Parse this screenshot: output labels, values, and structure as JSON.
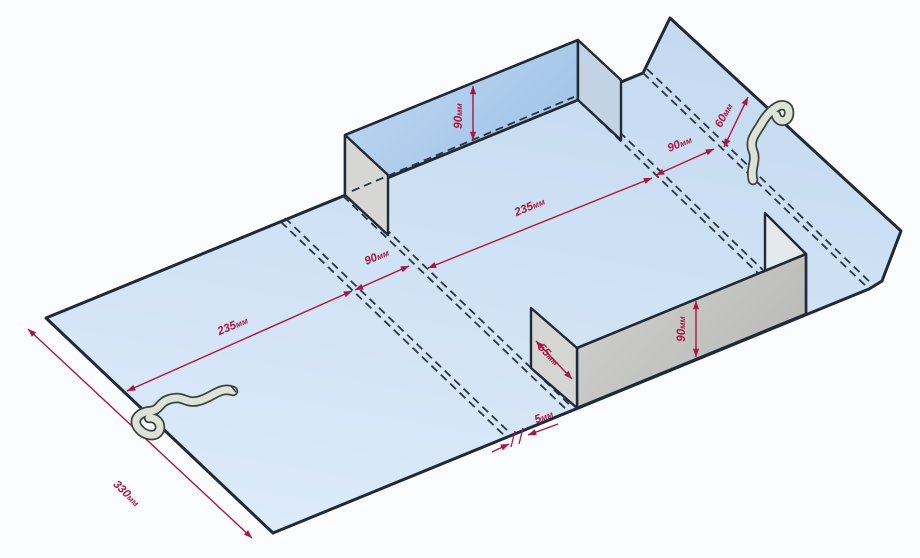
{
  "meta": {
    "description": "Isometric die-line drawing of a cardboard box blank with erected walls, fold lines, fabric straps and dimension annotations",
    "canvas": {
      "width": 920,
      "height": 558,
      "background": "#fbfcfd"
    }
  },
  "colors": {
    "outline": "#202a36",
    "fold": "#2a3542",
    "dimension": "#a81843",
    "strap_outline": "#3a433d",
    "strap_fill": "#dde2d6",
    "background": "#fbfcfd"
  },
  "dimension_labels": [
    "90мм",
    "60мм",
    "90мм",
    "235мм",
    "90мм",
    "235мм",
    "330мм",
    "55мм",
    "90мм",
    "5мм"
  ],
  "diagram": {
    "polygons": [
      {
        "name": "flat-sheet",
        "points": "46,318 643,73 670,18 901,231 882,281 869,289 273,533",
        "fill": {
          "type": "linear",
          "from": "#c5daf0",
          "to": "#dceafa",
          "x1": 0.6,
          "y1": 0,
          "x2": 0.3,
          "y2": 1
        },
        "stroke_width": 3
      },
      {
        "name": "front-wall-right-flap",
        "points": "765,213 806,254 806,314 765,273",
        "fill": "#e4e9ee",
        "stroke_width": 2.4
      },
      {
        "name": "front-wall",
        "points": "577,348 806,254 806,314 577,408",
        "fill": {
          "type": "linear",
          "from": "#cfd0ce",
          "to": "#b7b8b5",
          "x1": 0,
          "y1": 0.2,
          "x2": 1,
          "y2": 0.8
        },
        "stroke_width": 2.6
      },
      {
        "name": "front-wall-left-flap-55mm",
        "points": "531,308 577,348 577,408 531,368",
        "fill": "#d5d6d4",
        "stroke_width": 2.4
      },
      {
        "name": "back-wall",
        "points": "345,135 578,40 578,100 345,195",
        "fill": {
          "type": "linear",
          "from": "#c2d9f2",
          "to": "#9ec2e7",
          "x1": 0,
          "y1": 0,
          "x2": 1,
          "y2": 0.7
        },
        "stroke_width": 2.6
      },
      {
        "name": "back-wall-left-flap",
        "points": "345,135 388,175 388,235 345,195",
        "fill": "#d6d7d5",
        "stroke_width": 2.4
      },
      {
        "name": "back-wall-right-flap",
        "points": "578,40 621,80 621,140 578,100",
        "fill": "#c3d2e4",
        "stroke_width": 2.4
      }
    ],
    "fold_lines": [
      {
        "name": "fold-left-panel",
        "x1": 281,
        "y1": 222,
        "x2": 506,
        "y2": 437,
        "pair": true
      },
      {
        "name": "fold-left-band",
        "x1": 343,
        "y1": 196,
        "x2": 568,
        "y2": 411,
        "pair": true
      },
      {
        "name": "fold-right-band-near",
        "x1": 578,
        "y1": 100,
        "x2": 759,
        "y2": 274,
        "pair": true
      },
      {
        "name": "fold-right-band-far",
        "x1": 643,
        "y1": 73,
        "x2": 868,
        "y2": 288,
        "pair": true
      },
      {
        "name": "fold-back-wall-base",
        "x1": 352,
        "y1": 191,
        "x2": 574,
        "y2": 97,
        "pair": false
      }
    ],
    "dimensions": [
      {
        "name": "dim-back-wall-height",
        "x1": 473,
        "y1": 86,
        "x2": 473,
        "y2": 140,
        "arrows": "both",
        "label": {
          "text": "90мм",
          "x": 462,
          "y": 116,
          "rot": -90
        }
      },
      {
        "name": "dim-right-flap-60",
        "x1": 724,
        "y1": 147,
        "x2": 748,
        "y2": 97,
        "arrows": "both",
        "label": {
          "text": "60мм",
          "x": 727,
          "y": 117,
          "rot": -62
        }
      },
      {
        "name": "dim-right-band-90",
        "x1": 656,
        "y1": 175,
        "x2": 714,
        "y2": 149,
        "arrows": "both",
        "label": {
          "text": "90мм",
          "x": 681,
          "y": 147,
          "rot": -23
        }
      },
      {
        "name": "dim-center-panel-235",
        "x1": 428,
        "y1": 268,
        "x2": 652,
        "y2": 178,
        "arrows": "both",
        "label": {
          "text": "235мм",
          "x": 531,
          "y": 210,
          "rot": -23
        }
      },
      {
        "name": "dim-left-band-90",
        "x1": 355,
        "y1": 290,
        "x2": 409,
        "y2": 266,
        "arrows": "both",
        "label": {
          "text": "90мм",
          "x": 378,
          "y": 260,
          "rot": -23
        }
      },
      {
        "name": "dim-left-panel-235",
        "x1": 127,
        "y1": 391,
        "x2": 352,
        "y2": 291,
        "arrows": "both",
        "label": {
          "text": "235мм",
          "x": 234,
          "y": 329,
          "rot": -23
        }
      },
      {
        "name": "dim-left-edge-330",
        "x1": 28,
        "y1": 329,
        "x2": 252,
        "y2": 538,
        "arrows": "both",
        "label": {
          "text": "330мм",
          "x": 124,
          "y": 496,
          "rot": 44
        }
      },
      {
        "name": "dim-front-flap-55",
        "x1": 536,
        "y1": 341,
        "x2": 572,
        "y2": 379,
        "arrows": "both",
        "label": {
          "text": "55мм",
          "x": 546,
          "y": 357,
          "rot": 46
        }
      },
      {
        "name": "dim-front-wall-height",
        "x1": 696,
        "y1": 301,
        "x2": 696,
        "y2": 357,
        "arrows": "both",
        "label": {
          "text": "90мм",
          "x": 685,
          "y": 329,
          "rot": -90
        }
      },
      {
        "name": "dim-gap-5-leader-left",
        "x1": 492,
        "y1": 452,
        "x2": 509,
        "y2": 444,
        "arrows": "end",
        "label": null
      },
      {
        "name": "dim-gap-5-leader-right",
        "x1": 558,
        "y1": 424,
        "x2": 528,
        "y2": 435,
        "arrows": "end",
        "label": {
          "text": "5мм",
          "x": 545,
          "y": 420,
          "rot": -22
        }
      }
    ],
    "ticks": [
      {
        "name": "gap-5-tick-1",
        "x1": 515,
        "y1": 431,
        "x2": 511,
        "y2": 447
      },
      {
        "name": "gap-5-tick-2",
        "x1": 523,
        "y1": 428,
        "x2": 519,
        "y2": 444
      }
    ],
    "straps": [
      {
        "name": "strap-left",
        "path": "M 233 391 C 220 386 212 398 198 401 C 186 404 183 395 170 399 C 159 402 160 410 151 411 C 139 412 131 420 139 429 C 147 438 160 437 160 427 C 160 421 154 417 149 418",
        "tip": "M 231 386 L 236 392"
      },
      {
        "name": "strap-right",
        "path": "M 753 180 C 750 168 757 161 753 151 C 749 141 755 134 760 126 C 764 119 769 112 775 108 C 782 103 790 105 789 114 C 788 123 778 123 776 115",
        "tip": ""
      }
    ]
  }
}
